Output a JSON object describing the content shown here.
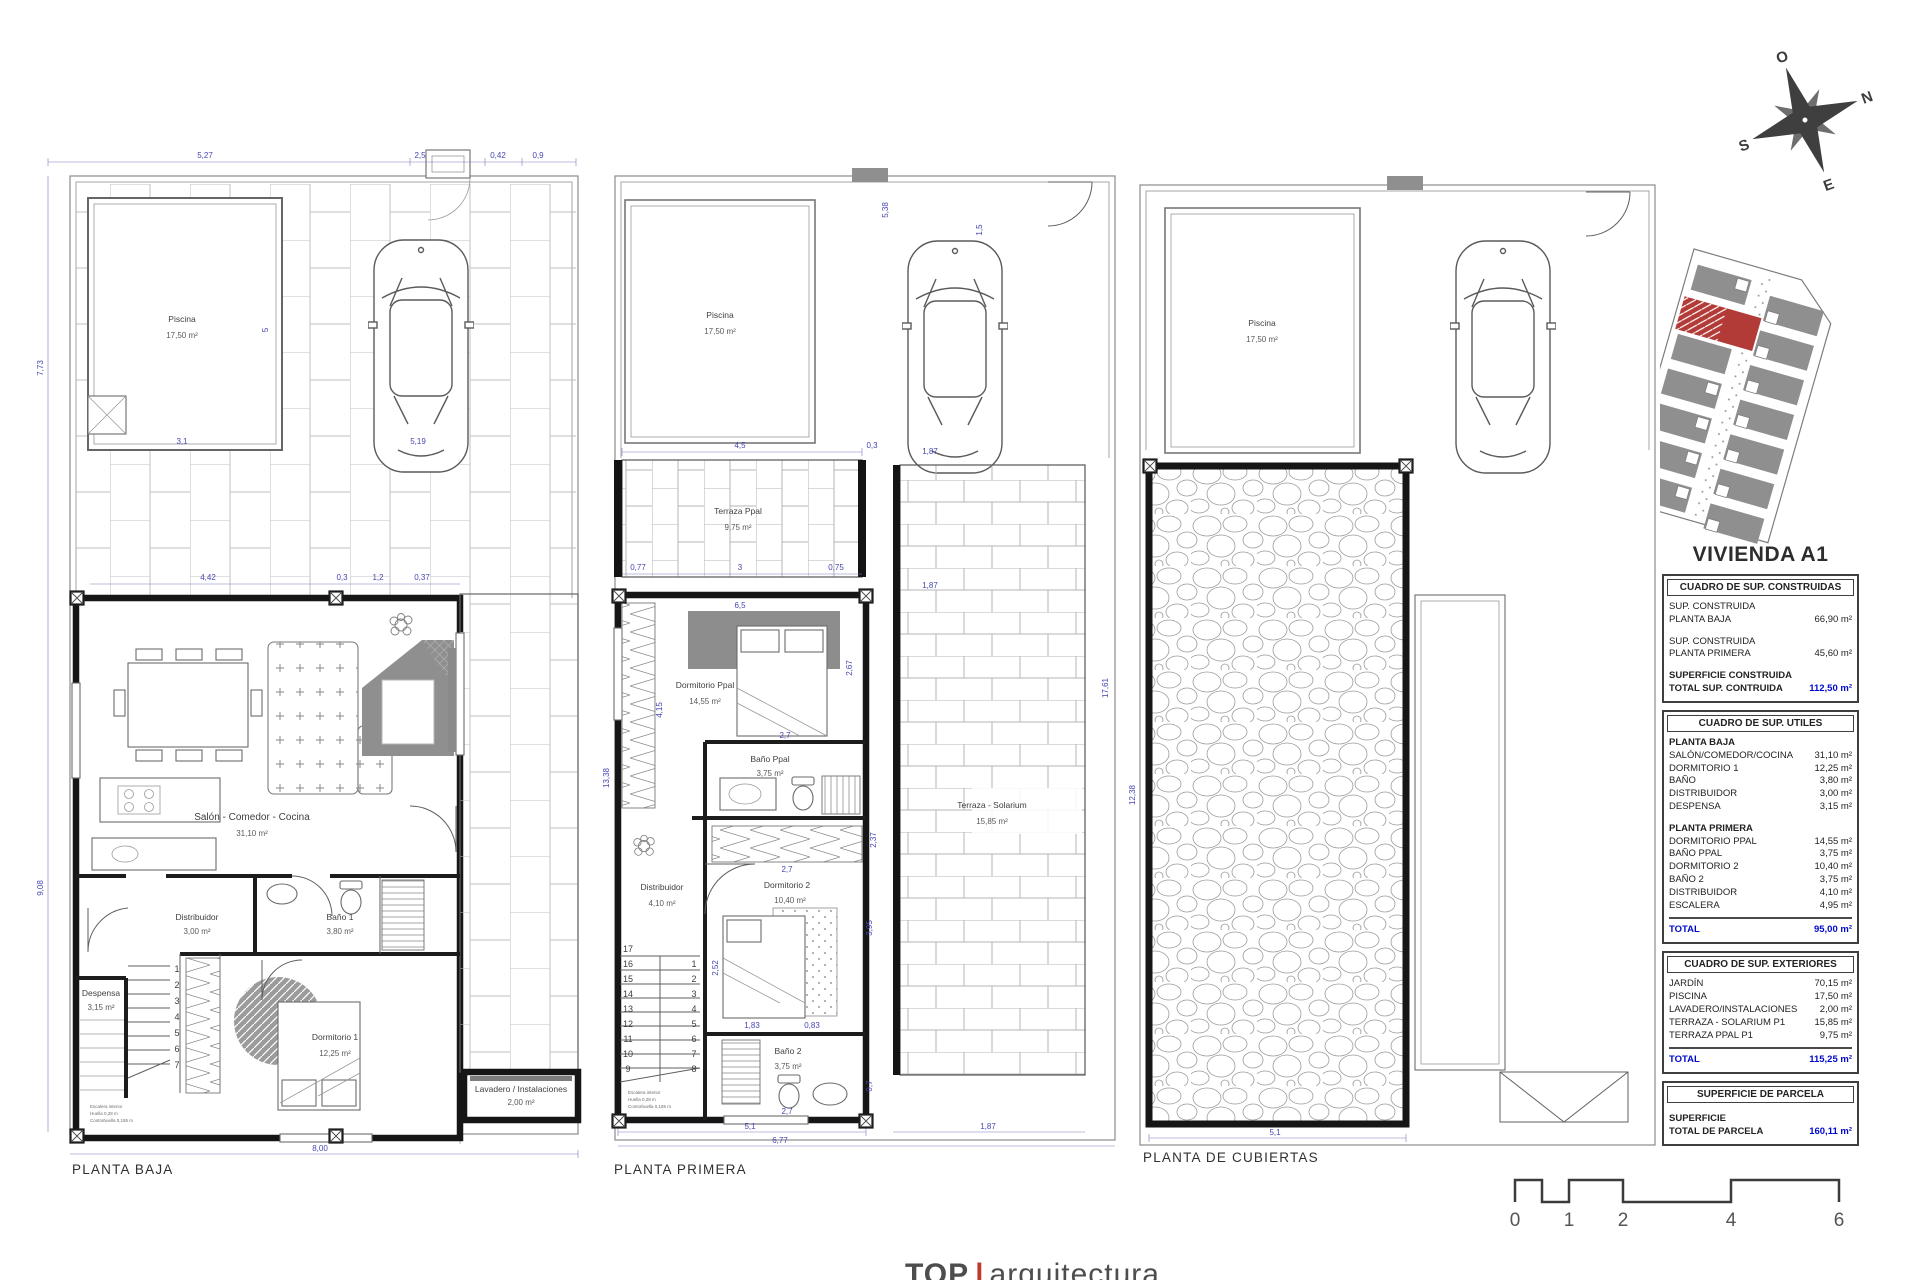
{
  "title": "VIVIENDA A1",
  "footer": {
    "brand_left": "TOP",
    "separator": "|",
    "brand_right": "arquitectura"
  },
  "compass": {
    "top": "O",
    "right": "N",
    "bottom": "E",
    "left": "S"
  },
  "scale_bar": {
    "labels": [
      "0",
      "1",
      "2",
      "4",
      "6"
    ]
  },
  "plans": {
    "baja": {
      "caption": "PLANTA BAJA",
      "pool": {
        "name": "Piscina",
        "area": "17,50 m²"
      },
      "rooms": {
        "salon": {
          "name": "Salón - Comedor - Cocina",
          "area": "31,10 m²"
        },
        "distribuidor": {
          "name": "Distribuidor",
          "area": "3,00 m²"
        },
        "bano1": {
          "name": "Baño 1",
          "area": "3,80 m²"
        },
        "despensa": {
          "name": "Despensa",
          "area": "3,15 m²"
        },
        "dormitorio1": {
          "name": "Dormitorio 1",
          "area": "12,25 m²"
        },
        "lavadero": {
          "name": "Lavadero / Instalaciones",
          "area": "2,00 m²"
        }
      },
      "stairs": [
        "1",
        "2",
        "3",
        "4",
        "5",
        "6",
        "7"
      ],
      "note": [
        "Escalera interior",
        "Huella 0,28 m",
        "Contrahuella 0,185 m"
      ],
      "dims": [
        "5,27",
        "2,5",
        "0,42",
        "0,9",
        "4,42",
        "0,3",
        "1,2",
        "0,37",
        "7,73",
        "9,08",
        "2,81",
        "0,9",
        "1,1",
        "3,1",
        "5",
        "5,19",
        "6,17",
        "2,5",
        "1",
        "2,87",
        "1,65",
        "0,85",
        "0,8",
        "1",
        "2,53",
        "4,37",
        "2,81",
        "2,12",
        "0,8",
        "6,77",
        "8,00"
      ]
    },
    "primera": {
      "caption": "PLANTA PRIMERA",
      "pool": {
        "name": "Piscina",
        "area": "17,50 m²"
      },
      "rooms": {
        "terraza": {
          "name": "Terraza Ppal",
          "area": "9,75 m²"
        },
        "dormppal": {
          "name": "Dormitorio Ppal",
          "area": "14,55 m²"
        },
        "banoppal": {
          "name": "Baño Ppal",
          "area": "3,75 m²"
        },
        "solarium": {
          "name": "Terraza - Solarium",
          "area": "15,85 m²"
        },
        "distribuidor": {
          "name": "Distribuidor",
          "area": "4,10 m²"
        },
        "dormitorio2": {
          "name": "Dormitorio 2",
          "area": "10,40 m²"
        },
        "bano2": {
          "name": "Baño 2",
          "area": "3,75 m²"
        }
      },
      "stairs_left": [
        "17",
        "16",
        "15",
        "14",
        "13",
        "12",
        "11",
        "10",
        "9"
      ],
      "stairs_right": [
        "1",
        "2",
        "3",
        "4",
        "5",
        "6",
        "7",
        "8"
      ],
      "note": [
        "Escalera interior",
        "Huella 0,28 m",
        "Contrahuella 0,185 m"
      ],
      "dims": [
        "5,38",
        "1,5",
        "4,5",
        "0,3",
        "0,77",
        "3",
        "0,75",
        "1,87",
        "1,87",
        "6,5",
        "4,15",
        "2,67",
        "2,7",
        "2,37",
        "3,95",
        "2,7",
        "1,83",
        "0,83",
        "2,52",
        "2,7",
        "0,7",
        "13,38",
        "17,61",
        "5,1",
        "6,77",
        "1,87"
      ]
    },
    "cubiertas": {
      "caption": "PLANTA DE CUBIERTAS",
      "pool": {
        "name": "Piscina",
        "area": "17,50 m²"
      },
      "dims": [
        "12,38",
        "5,1"
      ]
    }
  },
  "panel": {
    "constructed": {
      "header": "CUADRO DE SUP. CONSTRUIDAS",
      "rows": [
        {
          "label1": "SUP. CONSTRUIDA",
          "label2": "PLANTA BAJA",
          "value": "66,90 m²"
        },
        {
          "label1": "SUP. CONSTRUIDA",
          "label2": "PLANTA PRIMERA",
          "value": "45,60 m²"
        }
      ],
      "total_label1": "SUPERFICIE CONSTRUIDA",
      "total_label2": "TOTAL SUP. CONTRUIDA",
      "total_value": "112,50 m²"
    },
    "utiles": {
      "header": "CUADRO DE SUP. UTILES",
      "groups": [
        {
          "title": "PLANTA BAJA",
          "rows": [
            [
              "SALÓN/COMEDOR/COCINA",
              "31,10 m²"
            ],
            [
              "DORMITORIO 1",
              "12,25 m²"
            ],
            [
              "BAÑO",
              "3,80 m²"
            ],
            [
              "DISTRIBUIDOR",
              "3,00 m²"
            ],
            [
              "DESPENSA",
              "3,15 m²"
            ]
          ]
        },
        {
          "title": "PLANTA PRIMERA",
          "rows": [
            [
              "DORMITORIO PPAL",
              "14,55 m²"
            ],
            [
              "BAÑO PPAL",
              "3,75 m²"
            ],
            [
              "DORMITORIO 2",
              "10,40 m²"
            ],
            [
              "BAÑO 2",
              "3,75 m²"
            ],
            [
              "DISTRIBUIDOR",
              "4,10 m²"
            ],
            [
              "ESCALERA",
              "4,95 m²"
            ]
          ]
        }
      ],
      "total_label": "TOTAL",
      "total_value": "95,00 m²"
    },
    "exteriores": {
      "header": "CUADRO DE SUP. EXTERIORES",
      "rows": [
        [
          "JARDÍN",
          "70,15 m²"
        ],
        [
          "PISCINA",
          "17,50 m²"
        ],
        [
          "LAVADERO/INSTALACIONES",
          "2,00 m²"
        ],
        [
          "TERRAZA - SOLARIUM P1",
          "15,85 m²"
        ],
        [
          "TERRAZA PPAL P1",
          "9,75 m²"
        ]
      ],
      "total_label": "TOTAL",
      "total_value": "115,25 m²"
    },
    "parcela": {
      "header": "SUPERFICIE DE PARCELA",
      "total_label1": "SUPERFICIE",
      "total_label2": "TOTAL DE PARCELA",
      "total_value": "160,11 m²"
    }
  },
  "colors": {
    "dimension_blue": "#4545b2",
    "total_blue": "#0008cc",
    "site_red": "#b23b37",
    "line_gray": "#5f5f5f"
  }
}
